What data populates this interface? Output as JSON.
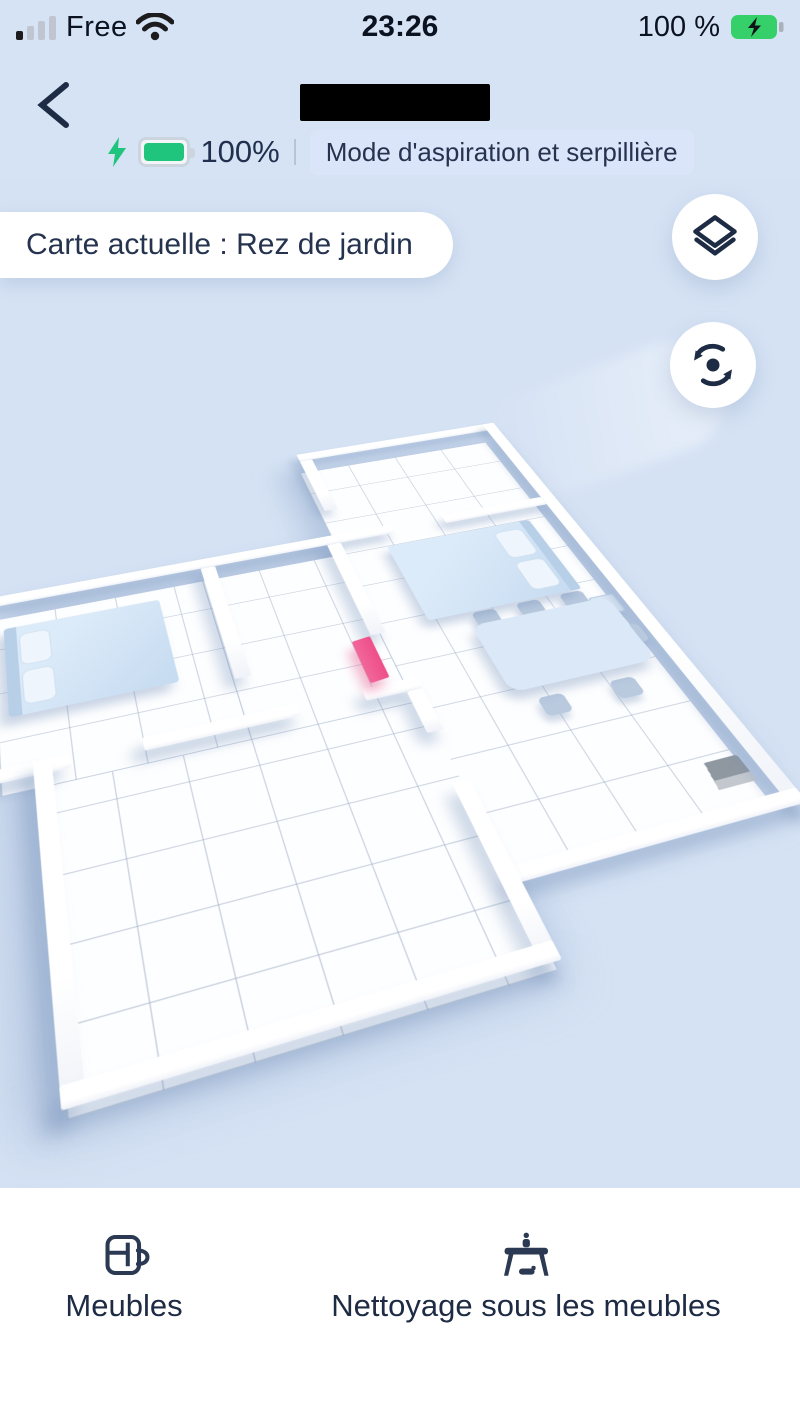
{
  "colors": {
    "background_blue": "#d6e3f5",
    "text_navy": "#21304e",
    "battery_green": "#1fc47d",
    "status_battery_green": "#35d06a",
    "virtual_wall_pink": "#ee4f88",
    "badge_background": "#dbe5f9"
  },
  "status_bar": {
    "carrier": "Free",
    "time": "23:26",
    "battery_pct": "100 %"
  },
  "header": {
    "battery_level": "100%",
    "mode_badge": "Mode d'aspiration et serpillière"
  },
  "map": {
    "current_map_label": "Carte actuelle : Rez de jardin",
    "objects": [
      "bed",
      "bed",
      "nightstand",
      "dining-table",
      "chairs",
      "virtual-wall-marker",
      "charging-dock"
    ]
  },
  "bottom_bar": {
    "items": [
      {
        "label": "Meubles"
      },
      {
        "label": "Nettoyage sous les meubles"
      }
    ]
  },
  "icons": [
    "signal-strength-icon",
    "wifi-icon",
    "battery-charging-icon",
    "back-icon",
    "charging-bolt-icon",
    "robot-battery-icon",
    "map-layers-icon",
    "map-rotate-icon",
    "furniture-icon",
    "clean-under-furniture-icon"
  ]
}
